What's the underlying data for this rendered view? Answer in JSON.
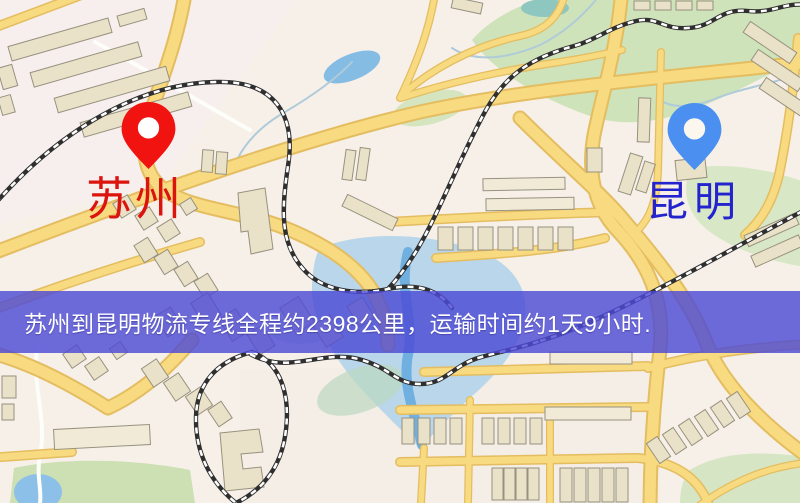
{
  "banner": {
    "text": "苏州到昆明物流专线全程约2398公里，运输时间约1天9小时.",
    "background_color": "#4d4bd6",
    "text_color": "#ffffff"
  },
  "markers": {
    "origin": {
      "label": "苏州",
      "pin_color": "#f01310",
      "label_color": "#dc140e"
    },
    "destination": {
      "label": "昆明",
      "pin_color": "#4b90f0",
      "label_color": "#2424cf"
    }
  },
  "map_colors": {
    "background": "#f6f0e8",
    "road_fill": "#f8da80",
    "road_casing": "#e4bd60",
    "water": "#9ac6e8",
    "park_green": "#cfe3ba",
    "building_fill": "#eae2c8",
    "building_stroke": "#97917f",
    "railway": "#2f2f2f"
  }
}
